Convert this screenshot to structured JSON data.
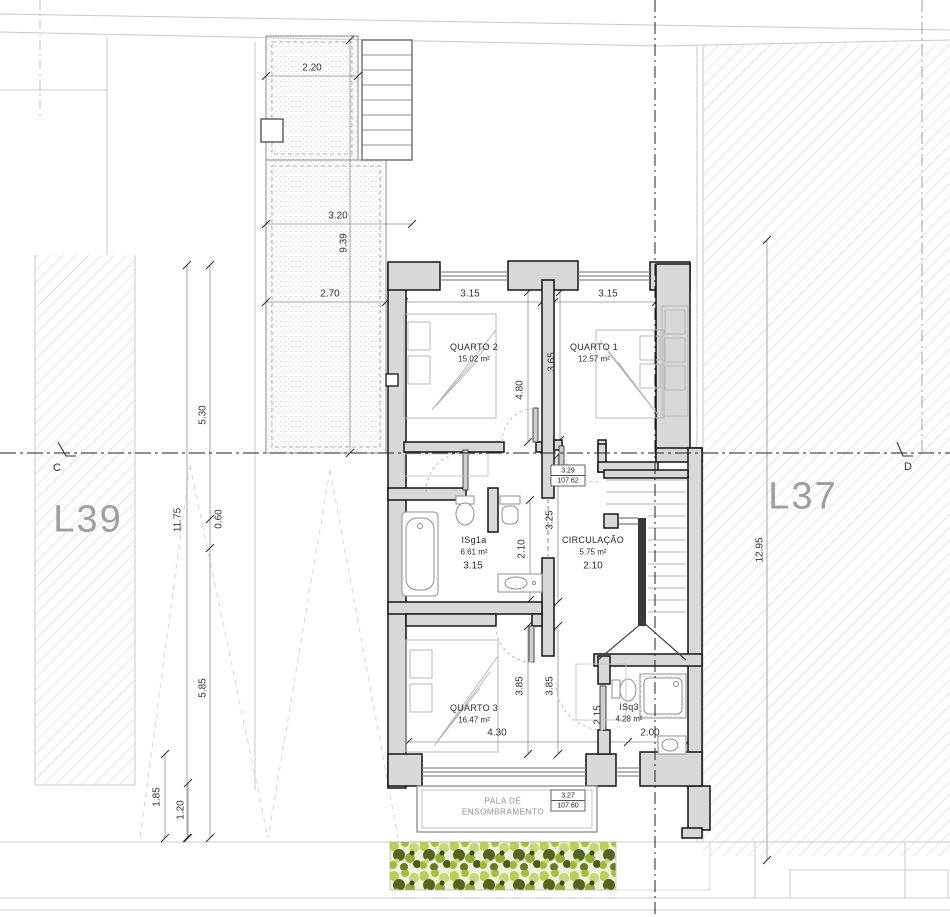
{
  "drawing_title": "Floor plan - upper floor",
  "lots": {
    "left": "L39",
    "right": "L37"
  },
  "section_markers": {
    "left": "C",
    "right": "D"
  },
  "rooms": {
    "quarto2": {
      "name": "QUARTO 2",
      "area": "15.02 m²"
    },
    "quarto1": {
      "name": "QUARTO 1",
      "area": "12.57 m²"
    },
    "isg1a": {
      "name": "ISg1a",
      "area": "6.61 m²",
      "width": "3.15"
    },
    "circulacao": {
      "name": "CIRCULAÇÃO",
      "area": "5.75 m²",
      "width": "2.10"
    },
    "quarto3": {
      "name": "QUARTO 3",
      "area": "16.47 m²"
    },
    "isq3": {
      "name": "ISq3",
      "area": "4.28 m²"
    }
  },
  "levels": {
    "upper": {
      "value": "3.29",
      "altitude": "107.62"
    },
    "lower": {
      "value": "3.27",
      "altitude": "107.60"
    }
  },
  "shading_canopy": {
    "line1": "PALA DE",
    "line2": "ENSOMBRAMENTO"
  },
  "dimensions": {
    "terrace_top": "2.20",
    "terrace_mid": "3.20",
    "terrace_length": "9.39",
    "terrace_low": "2.70",
    "left_a": "5.30",
    "left_total": "11.75",
    "left_b": "0.60",
    "left_c": "5.85",
    "left_d": "1.85",
    "left_e": "1.20",
    "right_total": "12.95",
    "quarto2_width": "3.15",
    "quarto1_width": "3.15",
    "quarto2_depth": "4.80",
    "quarto1_depth": "3.65",
    "hall_depth": "3.25",
    "isg1a_depth": "2.10",
    "quarto3_depth_a": "3.85",
    "quarto3_depth_b": "3.85",
    "quarto3_width": "4.30",
    "isq3_depth": "2.15",
    "isq3_width": "2.00"
  },
  "colors": {
    "wall_fill": "#d8d8d8",
    "wall_line": "#141414",
    "lot_hatch": "#cfcfcf",
    "lot_label": "#9e9e9e",
    "vegetation_light": "#b9cf55",
    "vegetation_dark": "#55631f"
  }
}
